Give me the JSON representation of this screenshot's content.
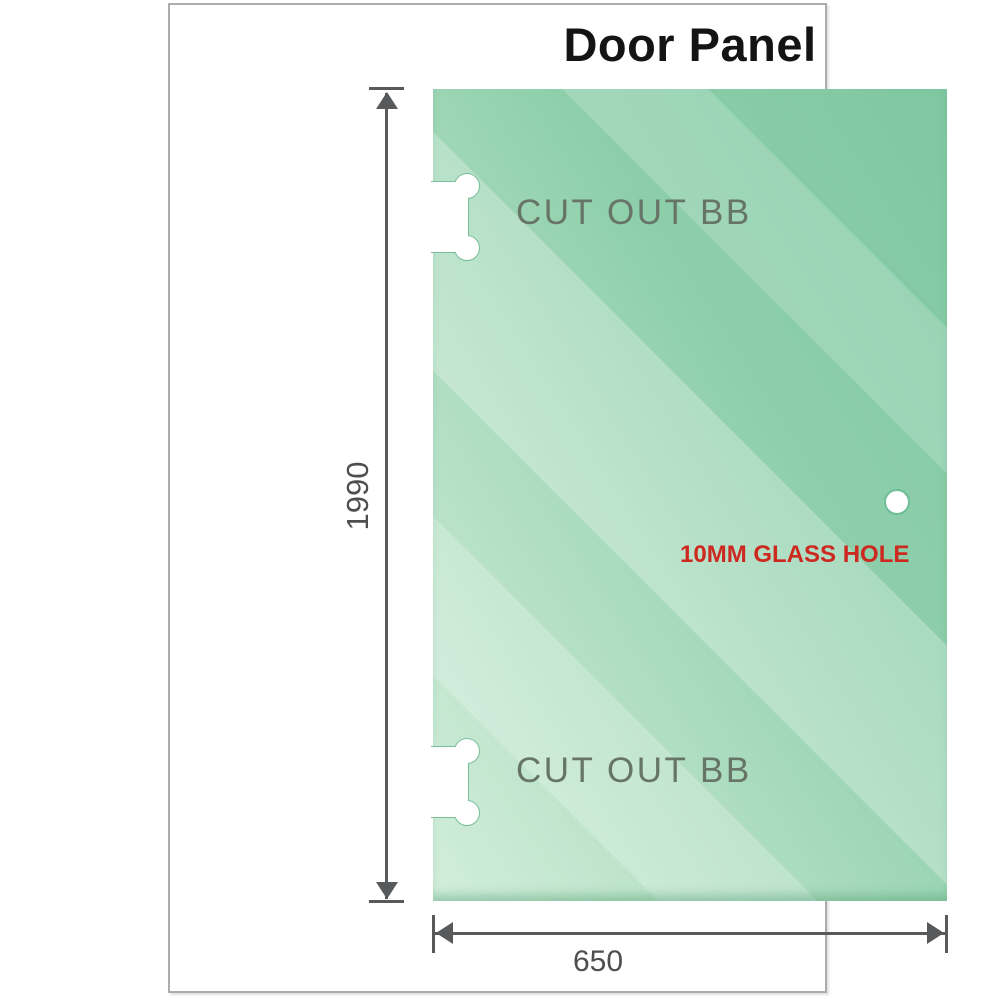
{
  "title": "Door Panel",
  "panel": {
    "cutout_top_label": "CUT OUT BB",
    "cutout_bottom_label": "CUT OUT BB",
    "glass_hole_label": "10MM GLASS HOLE"
  },
  "dimensions": {
    "height_value": "1990",
    "width_value": "650"
  },
  "colors": {
    "glass_dark": "#7ec7a1",
    "glass_light": "#d2eedb",
    "cutout_outline": "#7abf9b",
    "hole_ring": "#6fbd97",
    "hole_label_red": "#cc2920",
    "label_gray": "#677568",
    "dimension_gray": "#58595b",
    "dim_text": "#4d4e50",
    "title_black": "#141414",
    "frame_border": "#acacac"
  }
}
